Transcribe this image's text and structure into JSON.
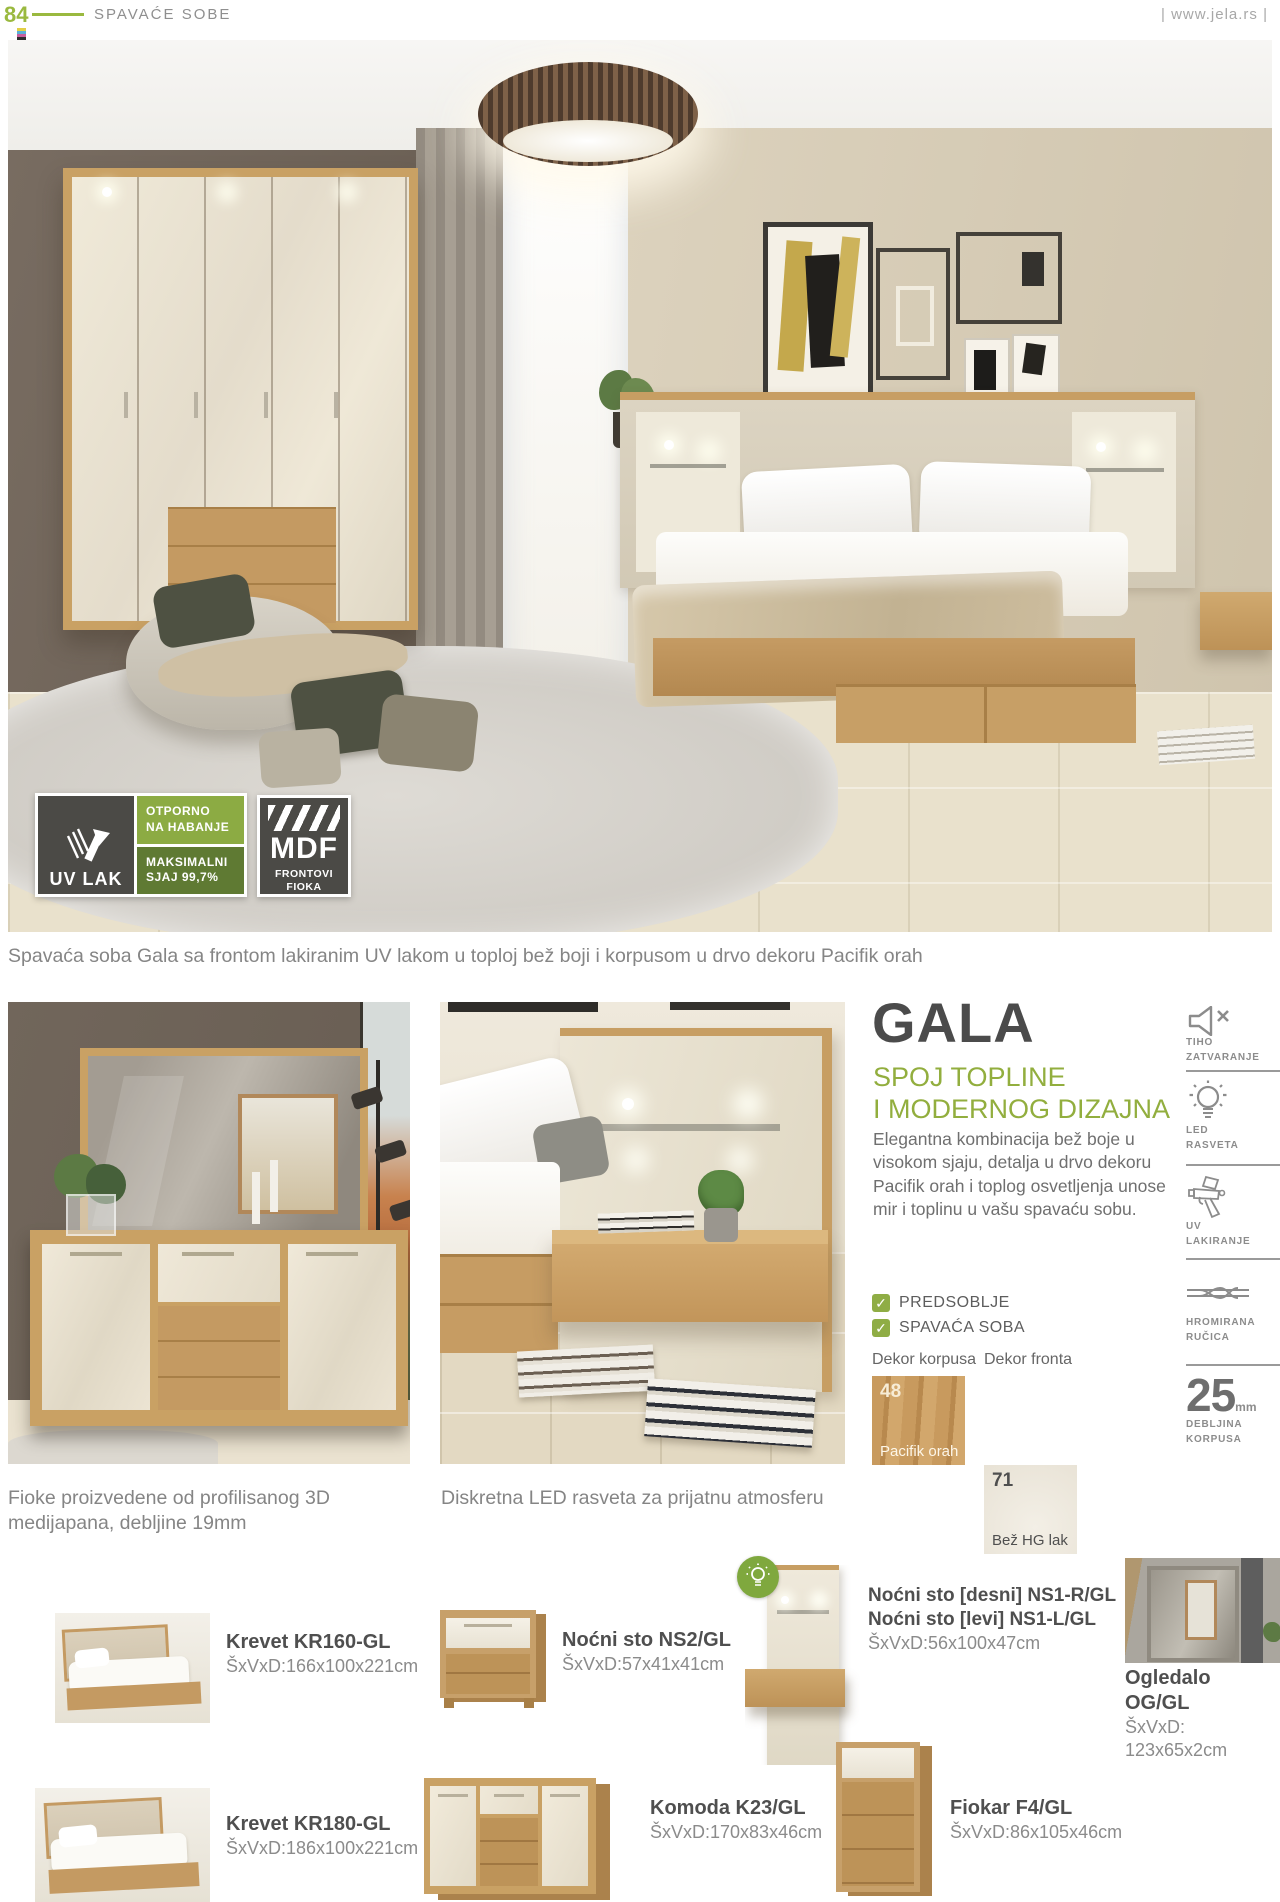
{
  "colors": {
    "accent_green": "#95b43f",
    "badge_green_light": "#8cab43",
    "badge_green_dark": "#5f7a33",
    "title_gray": "#4b4b4b",
    "body_gray": "#6f6f6f",
    "wood": "#c9a164",
    "cream_front": "#ece5d6"
  },
  "header": {
    "page_number": "84",
    "section_title": "SPAVAĆE SOBE",
    "website": "| www.jela.rs |"
  },
  "hero": {
    "badge_uv": {
      "title": "UV LAK",
      "line1": "OTPORNO\nNA HABANJE",
      "line2": "MAKSIMALNI\nSJAJ 99,7%"
    },
    "badge_mdf": {
      "title": "MDF",
      "subtitle": "FRONTOVI\nFIOKA"
    },
    "caption": "Spavaća soba Gala sa frontom lakiranim UV lakom u toploj bež boji i korpusom u drvo dekoru Pacifik orah"
  },
  "info": {
    "title": "GALA",
    "subtitle": "SPOJ TOPLINE\nI MODERNOG DIZAJNA",
    "description": "Elegantna kombinacija bež boje u visokom sjaju, detalja u drvo dekoru Pacifik orah i toplog osvetljenja unose mir i toplinu u vašu spavaću sobu.",
    "categories": [
      "PREDSOBLJE",
      "SPAVAĆA SOBA"
    ],
    "decors": [
      {
        "heading": "Dekor korpusa",
        "code": "48",
        "name": "Pacifik orah"
      },
      {
        "heading": "Dekor fronta",
        "code": "71",
        "name": "Bež HG lak"
      }
    ]
  },
  "features": [
    {
      "icon": "speaker-mute-icon",
      "label": "TIHO\nZATVARANJE"
    },
    {
      "icon": "led-bulb-icon",
      "label": "LED\nRASVETA"
    },
    {
      "icon": "spray-gun-icon",
      "label": "UV\nLAKIRANJE"
    },
    {
      "icon": "chrome-handle-icon",
      "label": "HROMIRANA\nRUČICA"
    },
    {
      "icon": "thickness-icon",
      "value": "25",
      "unit": "mm",
      "label": "DEBLJINA\nKORPUSA"
    }
  ],
  "captions": {
    "left": "Fioke proizvedene od profilisanog 3D\nmedijapana, debljine 19mm",
    "right": "Diskretna LED rasveta za prijatnu atmosferu"
  },
  "products": [
    {
      "name": "Krevet KR160-GL",
      "dims": "ŠxVxD:166x100x221cm"
    },
    {
      "name": "Noćni sto NS2/GL",
      "dims": "ŠxVxD:57x41x41cm"
    },
    {
      "name": "Noćni sto [desni] NS1-R/GL",
      "name2": "Noćni sto [levi] NS1-L/GL",
      "dims": "ŠxVxD:56x100x47cm"
    },
    {
      "name": "Ogledalo OG/GL",
      "dims": "ŠxVxD: 123x65x2cm"
    },
    {
      "name": "Krevet KR180-GL",
      "dims": "ŠxVxD:186x100x221cm"
    },
    {
      "name": "Komoda K23/GL",
      "dims": "ŠxVxD:170x83x46cm"
    },
    {
      "name": "Fiokar F4/GL",
      "dims": "ŠxVxD:86x105x46cm"
    }
  ]
}
